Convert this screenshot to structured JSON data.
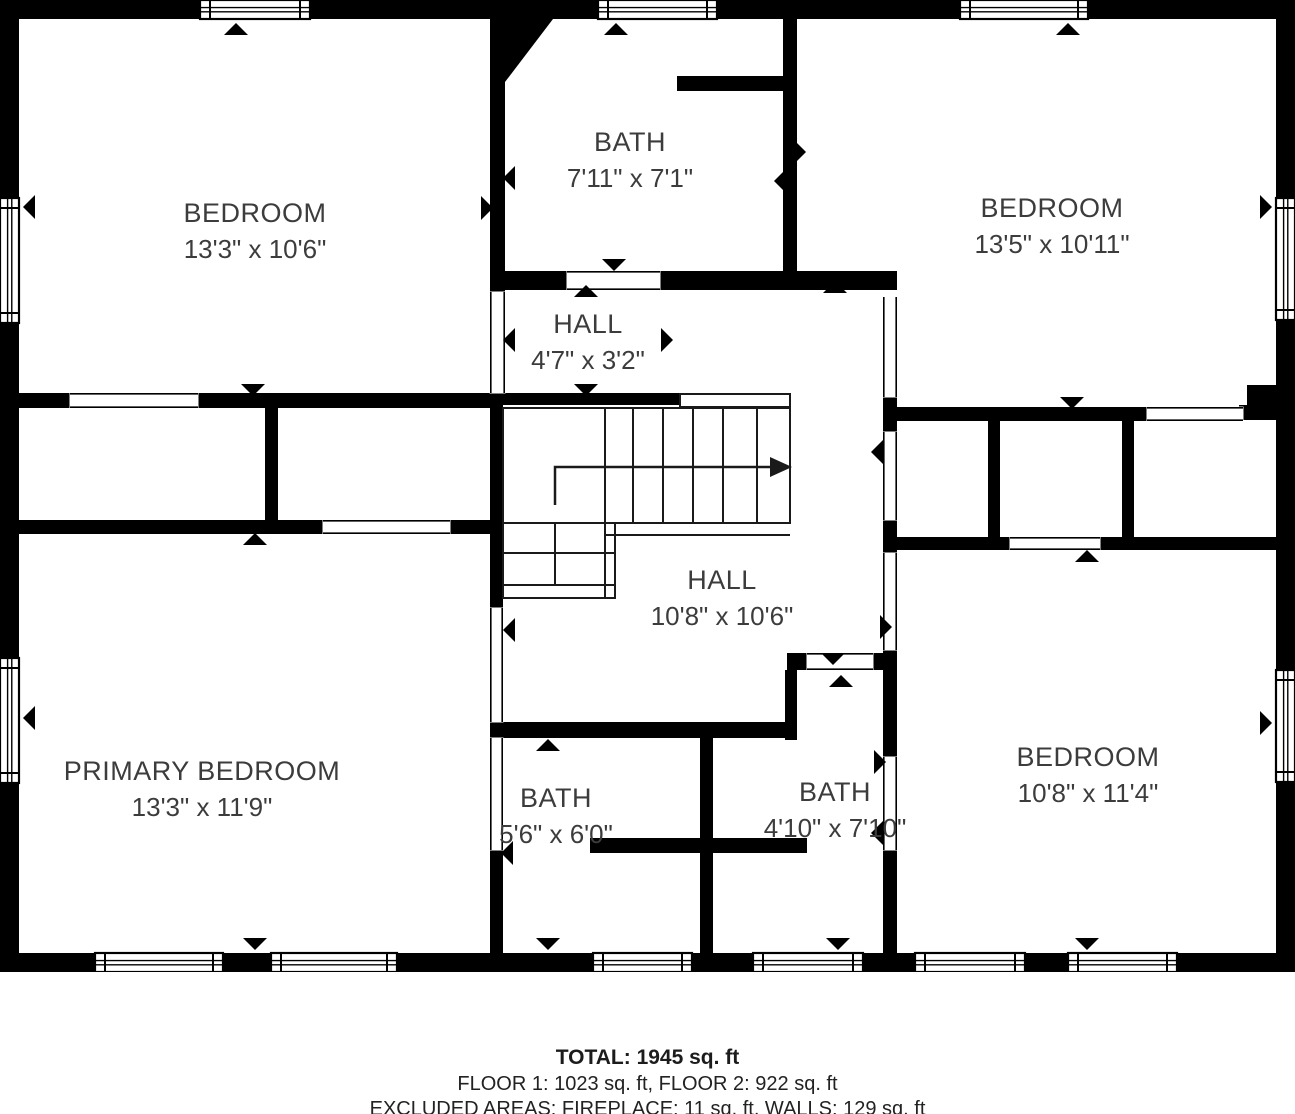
{
  "colors": {
    "wall": "#000000",
    "background": "#ffffff",
    "room_text": "#3c3c3c",
    "stair_line": "#1a1a1a",
    "footer_text": "#1c1c1c"
  },
  "rooms": [
    {
      "name": "BEDROOM",
      "dims": "13'3\" x 10'6\"",
      "cx": 255,
      "cy": 222
    },
    {
      "name": "BATH",
      "dims": "7'11\" x 7'1\"",
      "cx": 630,
      "cy": 151
    },
    {
      "name": "BEDROOM",
      "dims": "13'5\" x 10'11\"",
      "cx": 1052,
      "cy": 217
    },
    {
      "name": "HALL",
      "dims": "4'7\" x 3'2\"",
      "cx": 588,
      "cy": 333
    },
    {
      "name": "HALL",
      "dims": "10'8\" x 10'6\"",
      "cx": 722,
      "cy": 589
    },
    {
      "name": "PRIMARY BEDROOM",
      "dims": "13'3\" x 11'9\"",
      "cx": 202,
      "cy": 780
    },
    {
      "name": "BATH",
      "dims": "5'6\" x 6'0\"",
      "cx": 556,
      "cy": 807
    },
    {
      "name": "BATH",
      "dims": "4'10\" x 7'10\"",
      "cx": 835,
      "cy": 801
    },
    {
      "name": "BEDROOM",
      "dims": "10'8\" x 11'4\"",
      "cx": 1088,
      "cy": 766
    }
  ],
  "footer": {
    "total": "TOTAL: 1945 sq. ft",
    "floors": "FLOOR 1: 1023 sq. ft, FLOOR 2: 922 sq. ft",
    "excluded": "EXCLUDED AREAS: FIREPLACE: 11 sq. ft, WALLS: 129 sq. ft"
  },
  "plan": {
    "width": 1295,
    "height": 972,
    "walls": [
      [
        0,
        0,
        1295,
        19
      ],
      [
        0,
        953,
        1295,
        19
      ],
      [
        0,
        0,
        19,
        972
      ],
      [
        1276,
        0,
        19,
        972
      ],
      [
        490,
        19,
        15,
        273
      ],
      [
        677,
        76,
        106,
        15
      ],
      [
        783,
        19,
        14,
        252
      ],
      [
        498,
        271,
        69,
        19
      ],
      [
        660,
        271,
        237,
        19
      ],
      [
        883,
        397,
        14,
        35
      ],
      [
        883,
        520,
        14,
        33
      ],
      [
        883,
        650,
        14,
        107
      ],
      [
        883,
        850,
        14,
        103
      ],
      [
        895,
        407,
        252,
        14
      ],
      [
        988,
        421,
        12,
        116
      ],
      [
        1122,
        407,
        12,
        143
      ],
      [
        895,
        537,
        115,
        13
      ],
      [
        1100,
        537,
        176,
        13
      ],
      [
        1247,
        385,
        29,
        35
      ],
      [
        1239,
        405,
        10,
        15
      ],
      [
        19,
        393,
        51,
        15
      ],
      [
        198,
        393,
        295,
        15
      ],
      [
        265,
        408,
        13,
        114
      ],
      [
        19,
        520,
        304,
        14
      ],
      [
        450,
        520,
        43,
        14
      ],
      [
        490,
        393,
        13,
        215
      ],
      [
        490,
        722,
        13,
        16
      ],
      [
        490,
        850,
        13,
        103
      ],
      [
        490,
        722,
        305,
        16
      ],
      [
        700,
        738,
        13,
        215
      ],
      [
        590,
        838,
        110,
        15
      ],
      [
        713,
        838,
        94,
        15
      ],
      [
        787,
        653,
        20,
        17
      ],
      [
        873,
        653,
        20,
        17
      ],
      [
        785,
        670,
        12,
        70
      ],
      [
        503,
        393,
        177,
        12
      ]
    ],
    "chamfer": "490,19 553,19 505,82 490,82",
    "windows": [
      {
        "r": [
          200,
          0,
          110,
          19
        ],
        "o": "h"
      },
      {
        "r": [
          598,
          0,
          119,
          19
        ],
        "o": "h"
      },
      {
        "r": [
          960,
          0,
          128,
          19
        ],
        "o": "h"
      },
      {
        "r": [
          0,
          198,
          19,
          125
        ],
        "o": "v"
      },
      {
        "r": [
          0,
          658,
          19,
          125
        ],
        "o": "v"
      },
      {
        "r": [
          1276,
          198,
          19,
          122
        ],
        "o": "v"
      },
      {
        "r": [
          1276,
          670,
          19,
          112
        ],
        "o": "v"
      },
      {
        "r": [
          95,
          953,
          128,
          19
        ],
        "o": "h"
      },
      {
        "r": [
          271,
          953,
          126,
          19
        ],
        "o": "h"
      },
      {
        "r": [
          593,
          953,
          99,
          19
        ],
        "o": "h"
      },
      {
        "r": [
          753,
          953,
          110,
          19
        ],
        "o": "h"
      },
      {
        "r": [
          915,
          953,
          110,
          19
        ],
        "o": "h"
      },
      {
        "r": [
          1068,
          953,
          109,
          19
        ],
        "o": "h"
      }
    ],
    "door_openings": [
      {
        "r": [
          490,
          292,
          15,
          101
        ],
        "o": "v"
      },
      {
        "r": [
          567,
          271,
          93,
          19
        ],
        "o": "h"
      },
      {
        "r": [
          883,
          297,
          14,
          100
        ],
        "o": "v"
      },
      {
        "r": [
          1147,
          407,
          96,
          14
        ],
        "o": "h"
      },
      {
        "r": [
          883,
          432,
          14,
          88
        ],
        "o": "v"
      },
      {
        "r": [
          1010,
          537,
          90,
          13
        ],
        "o": "h"
      },
      {
        "r": [
          883,
          553,
          14,
          97
        ],
        "o": "v"
      },
      {
        "r": [
          883,
          757,
          14,
          93
        ],
        "o": "v"
      },
      {
        "r": [
          807,
          653,
          66,
          17
        ],
        "o": "h"
      },
      {
        "r": [
          490,
          608,
          13,
          114
        ],
        "o": "v"
      },
      {
        "r": [
          490,
          738,
          13,
          112
        ],
        "o": "v"
      },
      {
        "r": [
          70,
          393,
          128,
          15
        ],
        "o": "h"
      },
      {
        "r": [
          323,
          520,
          127,
          14
        ],
        "o": "h"
      }
    ],
    "markers": [
      {
        "x": 236,
        "y": 29,
        "d": "up"
      },
      {
        "x": 616,
        "y": 29,
        "d": "up"
      },
      {
        "x": 1068,
        "y": 29,
        "d": "up"
      },
      {
        "x": 29,
        "y": 207,
        "d": "left"
      },
      {
        "x": 29,
        "y": 718,
        "d": "left"
      },
      {
        "x": 1266,
        "y": 207,
        "d": "right"
      },
      {
        "x": 1266,
        "y": 723,
        "d": "right"
      },
      {
        "x": 255,
        "y": 944,
        "d": "down"
      },
      {
        "x": 548,
        "y": 944,
        "d": "down"
      },
      {
        "x": 838,
        "y": 944,
        "d": "down"
      },
      {
        "x": 1087,
        "y": 944,
        "d": "down"
      },
      {
        "x": 509,
        "y": 178,
        "d": "left"
      },
      {
        "x": 487,
        "y": 208,
        "d": "right"
      },
      {
        "x": 800,
        "y": 152,
        "d": "right"
      },
      {
        "x": 780,
        "y": 181,
        "d": "left"
      },
      {
        "x": 614,
        "y": 265,
        "d": "down"
      },
      {
        "x": 586,
        "y": 291,
        "d": "up"
      },
      {
        "x": 509,
        "y": 340,
        "d": "left"
      },
      {
        "x": 667,
        "y": 340,
        "d": "right"
      },
      {
        "x": 586,
        "y": 390,
        "d": "down"
      },
      {
        "x": 835,
        "y": 287,
        "d": "up"
      },
      {
        "x": 253,
        "y": 390,
        "d": "down"
      },
      {
        "x": 255,
        "y": 539,
        "d": "up"
      },
      {
        "x": 1072,
        "y": 403,
        "d": "down"
      },
      {
        "x": 877,
        "y": 452,
        "d": "left"
      },
      {
        "x": 886,
        "y": 627,
        "d": "right"
      },
      {
        "x": 1087,
        "y": 556,
        "d": "up"
      },
      {
        "x": 833,
        "y": 659,
        "d": "down"
      },
      {
        "x": 841,
        "y": 681,
        "d": "up"
      },
      {
        "x": 877,
        "y": 833,
        "d": "left"
      },
      {
        "x": 880,
        "y": 762,
        "d": "right"
      },
      {
        "x": 509,
        "y": 630,
        "d": "left"
      },
      {
        "x": 507,
        "y": 853,
        "d": "left"
      },
      {
        "x": 548,
        "y": 745,
        "d": "up"
      }
    ],
    "stairs": {
      "main_box": [
        503,
        408,
        287,
        115
      ],
      "treads_x": [
        605,
        633,
        663,
        693,
        723,
        757
      ],
      "treads_y": [
        408,
        523
      ],
      "winder_box": [
        503,
        523,
        112,
        75
      ],
      "lines": [
        [
          605,
          535,
          790,
          535
        ],
        [
          605,
          523,
          605,
          598
        ],
        [
          615,
          535,
          615,
          598
        ],
        [
          503,
          553,
          615,
          553
        ],
        [
          503,
          585,
          615,
          585
        ],
        [
          555,
          523,
          555,
          585
        ]
      ],
      "landing_strip": [
        680,
        394,
        110,
        13
      ],
      "arrow_path": [
        [
          555,
          505
        ],
        [
          555,
          467
        ],
        [
          770,
          467
        ]
      ],
      "arrow_head": "770,457 792,467 770,477"
    }
  }
}
